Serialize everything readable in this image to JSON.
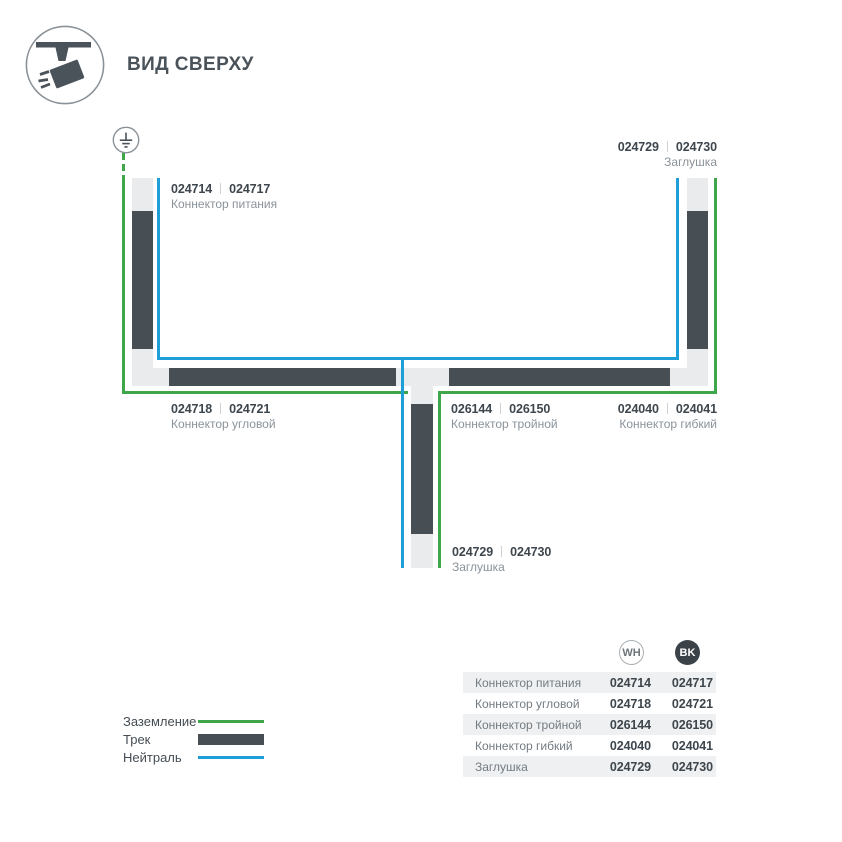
{
  "header": {
    "title": "ВИД СВЕРХУ"
  },
  "icons": {
    "badge": "track-spotlight-icon",
    "ground": "earth-ground-icon",
    "wh_marker": "outlined-circle",
    "bk_marker": "filled-dark-circle"
  },
  "colors": {
    "ground_green": "#3fa64c",
    "neutral_blue": "#1f9fd8",
    "track_dark": "#474e54",
    "connector_light": "#e9ebec"
  },
  "diagram": {
    "labels": {
      "power": {
        "wh": "024714",
        "bk": "024717",
        "name": "Коннектор питания"
      },
      "endcap_top": {
        "wh": "024729",
        "bk": "024730",
        "name": "Заглушка"
      },
      "corner": {
        "wh": "024718",
        "bk": "024721",
        "name": "Коннектор угловой"
      },
      "triple": {
        "wh": "026144",
        "bk": "026150",
        "name": "Коннектор тройной"
      },
      "flex": {
        "wh": "024040",
        "bk": "024041",
        "name": "Коннектор гибкий"
      },
      "endcap_bottom": {
        "wh": "024729",
        "bk": "024730",
        "name": "Заглушка"
      }
    }
  },
  "legend": {
    "ground": "Заземление",
    "track": "Трек",
    "neutral": "Нейтраль"
  },
  "table": {
    "col_wh": "WH",
    "col_bk": "BK",
    "rows": [
      {
        "name": "Коннектор питания",
        "wh": "024714",
        "bk": "024717"
      },
      {
        "name": "Коннектор угловой",
        "wh": "024718",
        "bk": "024721"
      },
      {
        "name": "Коннектор тройной",
        "wh": "026144",
        "bk": "026150"
      },
      {
        "name": "Коннектор гибкий",
        "wh": "024040",
        "bk": "024041"
      },
      {
        "name": "Заглушка",
        "wh": "024729",
        "bk": "024730"
      }
    ]
  }
}
